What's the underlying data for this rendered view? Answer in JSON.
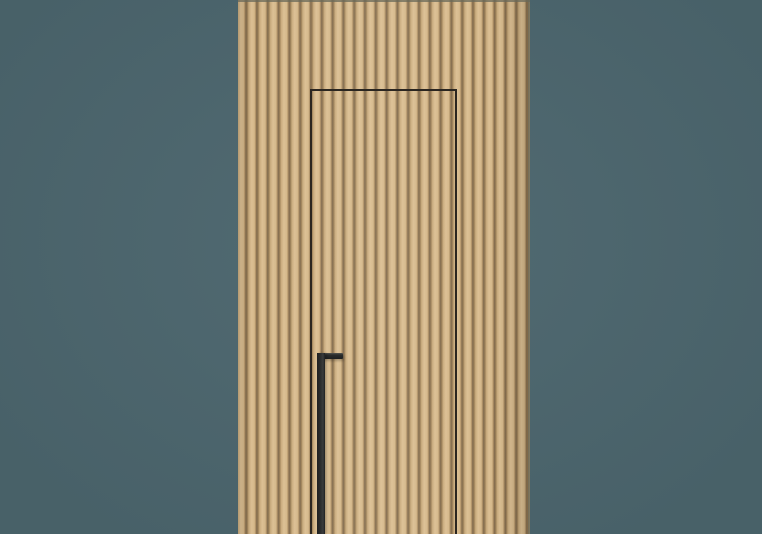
{
  "scene": {
    "description": "Product render of a concealed flush door in a vertical wood-slat wall panel with a long black handle, on a teal studio background",
    "elements": [
      "studio-background",
      "wood-slat-panel",
      "concealed-door-gap-outline",
      "door-handle"
    ]
  },
  "colors": {
    "bg": "#4c666e",
    "wood-light": "#dcc094",
    "wood-board": "#d5b88a",
    "wood-mid": "#c9ab7d",
    "wood-groove-hi": "#b49569",
    "wood-groove": "#7f694c",
    "wood-groove-lo": "#9d8158",
    "panel-edge": "#6a6a5a",
    "gap-line": "#2b2620",
    "handle": "#2a2c2c",
    "handle-hi": "#55554f",
    "handle-hi2": "#3a3c3c",
    "handle-lo": "#1e2021"
  },
  "geometry_px": {
    "panel-left": 238,
    "panel-width": 292,
    "door-left": 310,
    "door-top": 89,
    "door-width": 147,
    "handle-left": 317,
    "handle-top": 353,
    "handle-bar-width": 26,
    "handle-bar-height": 6,
    "handle-stem-width": 8
  }
}
